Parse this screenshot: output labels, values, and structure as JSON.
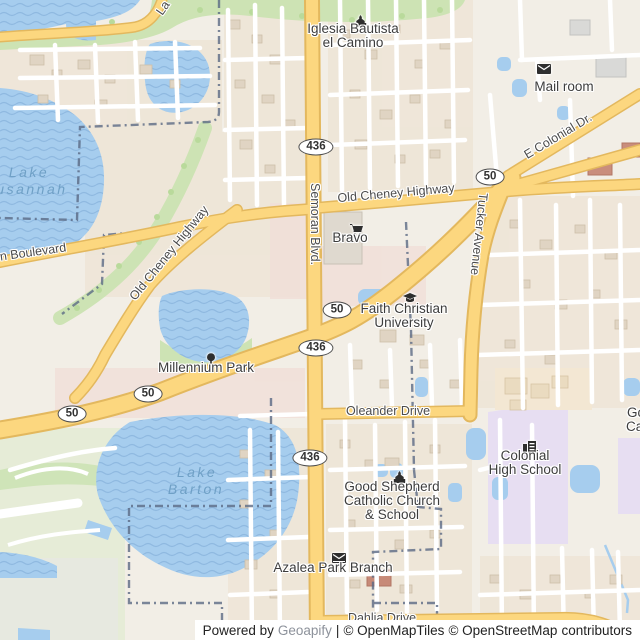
{
  "map": {
    "lakes": {
      "susannah_line1": "Lake",
      "susannah_line2": "Susannah",
      "barton_line1": "Lake",
      "barton_line2": "Barton"
    },
    "roads": {
      "e_colonial": "E Colonial Dr.",
      "old_cheney_east": "Old Cheney Highway",
      "old_cheney_west": "Old Cheney Highway",
      "semoran": "Semoran Blvd.",
      "tucker": "Tucker Avenue",
      "boulevard_partial": "n Boulevard",
      "oleander": "Oleander Drive",
      "dahlia": "Dahlia Drive",
      "la_partial": "La"
    },
    "shields": {
      "sr436": "436",
      "sr50": "50"
    },
    "pois": {
      "iglesia": {
        "line1": "Iglesia Bautista",
        "line2": "el Camino",
        "icon": "church-icon"
      },
      "mailroom": {
        "label": "Mail room",
        "icon": "mail-icon"
      },
      "bravo": {
        "label": "Bravo",
        "icon": "shopping-cart-icon"
      },
      "faith": {
        "line1": "Faith Christian",
        "line2": "University",
        "icon": "graduation-cap-icon"
      },
      "millennium": {
        "label": "Millennium Park",
        "icon": "tree-icon"
      },
      "colonial_hs": {
        "line1": "Colonial",
        "line2": "High School",
        "icon": "school-icon"
      },
      "good_shepherd": {
        "line1": "Good Shepherd",
        "line2": "Catholic Church",
        "line3": "& School",
        "icon": "church-icon"
      },
      "azalea": {
        "label": "Azalea Park Branch",
        "icon": "library-book-icon"
      }
    },
    "partial_labels": {
      "go": "Go",
      "ca": "Ca"
    },
    "colors": {
      "water": "#a6cdee",
      "road_primary_fill": "#fcd77f",
      "road_primary_casing": "#e3b85e",
      "greenery": "#cde3b4",
      "campus": "#e7def2",
      "boundary": "#5b6a85"
    },
    "attribution": {
      "powered_by": "Powered by",
      "geoapify": "Geoapify",
      "separator": "|",
      "openmaptiles": "© OpenMapTiles",
      "openstreetmap": "© OpenStreetMap",
      "contributors": "contributors"
    }
  }
}
